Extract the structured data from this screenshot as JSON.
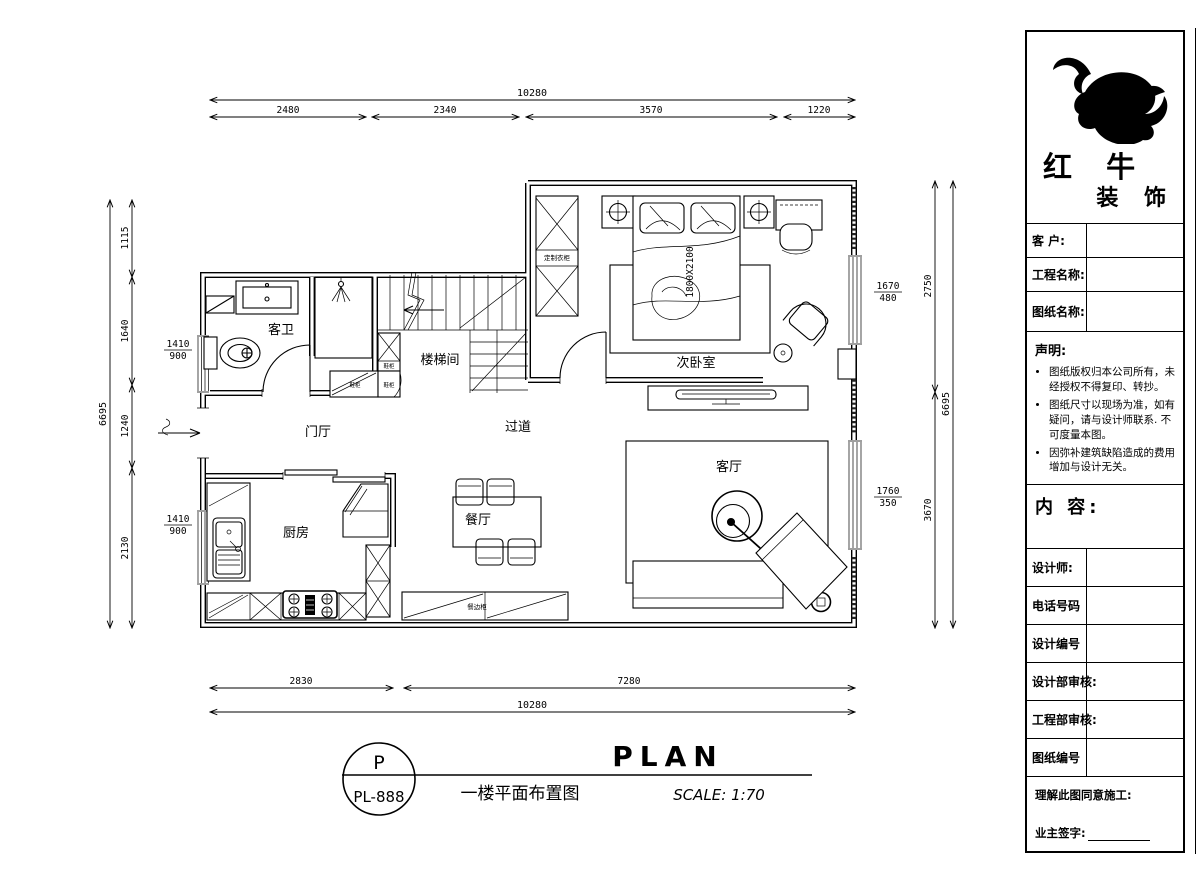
{
  "plan": {
    "rooms": {
      "guest_bath": "客卫",
      "stairwell": "楼梯间",
      "second_bedroom": "次卧室",
      "foyer": "门厅",
      "corridor": "过道",
      "living_room": "客厅",
      "kitchen": "厨房",
      "dining_room": "餐厅"
    },
    "furniture": {
      "custom_wardrobe": "定制衣柜",
      "shoe_cabinet": "鞋柜",
      "sideboard": "餐边柜",
      "bed_size": "1800X2100"
    },
    "dims": {
      "top_total": "10280",
      "top_seg_1": "2480",
      "top_seg_2": "2340",
      "top_seg_3": "3570",
      "top_seg_4": "1220",
      "bottom_seg_1": "2830",
      "bottom_seg_2": "7280",
      "bottom_total": "10280",
      "left_total": "6695",
      "left_seg_1": "1115",
      "left_seg_2": "1640",
      "left_seg_3": "1240",
      "left_seg_4": "2130",
      "right_seg_1": "2750",
      "right_seg_2": "3670",
      "right_total": "6695",
      "callout_bath_w": "1410",
      "callout_bath_h": "900",
      "callout_kitchen_w": "1410",
      "callout_kitchen_h": "900",
      "callout_bedroom_w": "1670",
      "callout_bedroom_h": "480",
      "callout_living_w": "1760",
      "callout_living_h": "350"
    }
  },
  "title_block": {
    "brand_line_1": "红 牛",
    "brand_line_2": "装 饰",
    "field_client": "客  户:",
    "field_project": "工程名称:",
    "field_drawing": "图纸名称:",
    "statement_title": "声明:",
    "statement_item_1": "图纸版权归本公司所有，未经授权不得复印、转抄。",
    "statement_item_2": "图纸尺寸以现场为准，如有疑问，请与设计师联系. 不可度量本图。",
    "statement_item_3": "因弥补建筑缺陷造成的费用增加与设计无关。",
    "content_title": "内 容:",
    "row_designer": "设计师:",
    "row_phone": "电话号码",
    "row_design_no": "设计编号",
    "row_design_review": "设计部审核:",
    "row_eng_review": "工程部审核:",
    "row_drawing_no": "图纸编号",
    "footer_agree": "理解此图同意施工:",
    "footer_sign": "业主签字:"
  },
  "sheet_footer": {
    "stamp_top": "P",
    "stamp_bottom": "PL-888",
    "title_en": "PLAN",
    "title_cn": "一楼平面布置图",
    "scale": "SCALE: 1:70"
  }
}
